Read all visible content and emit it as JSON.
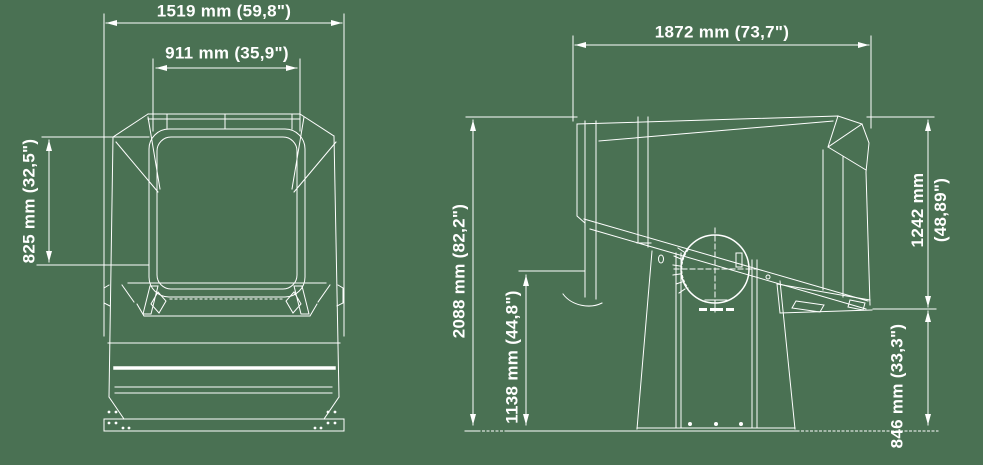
{
  "canvas": {
    "background_color": "#4a7153",
    "line_color": "#ffffff",
    "description": "Technical dimensional line drawing of a searchlight: front view (left) and side view on pedestal (right)"
  },
  "views": {
    "front": {
      "name": "front view"
    },
    "side": {
      "name": "side view"
    }
  },
  "icons": {
    "brand_mark": "tiny-illegible-logo-text-under-pivot-circle"
  },
  "dimensions": {
    "width_overall": {
      "label": "1519 mm (59,8\")",
      "orientation": "horizontal"
    },
    "width_lens": {
      "label": "911 mm (35,9\")",
      "orientation": "horizontal"
    },
    "height_lens": {
      "label": "825 mm (32,5\")",
      "orientation": "vertical"
    },
    "depth_overall": {
      "label": "1872 mm (73,7\")",
      "orientation": "horizontal"
    },
    "height_overall": {
      "label": "2088 mm (82,2\")",
      "orientation": "vertical"
    },
    "height_rear": {
      "label": "1138 mm (44,8\")",
      "orientation": "vertical"
    },
    "height_head": {
      "line1": "1242 mm",
      "line2": "(48,89\")",
      "orientation": "vertical"
    },
    "height_pedestal": {
      "label": "846 mm (33,3\")",
      "orientation": "vertical"
    }
  }
}
